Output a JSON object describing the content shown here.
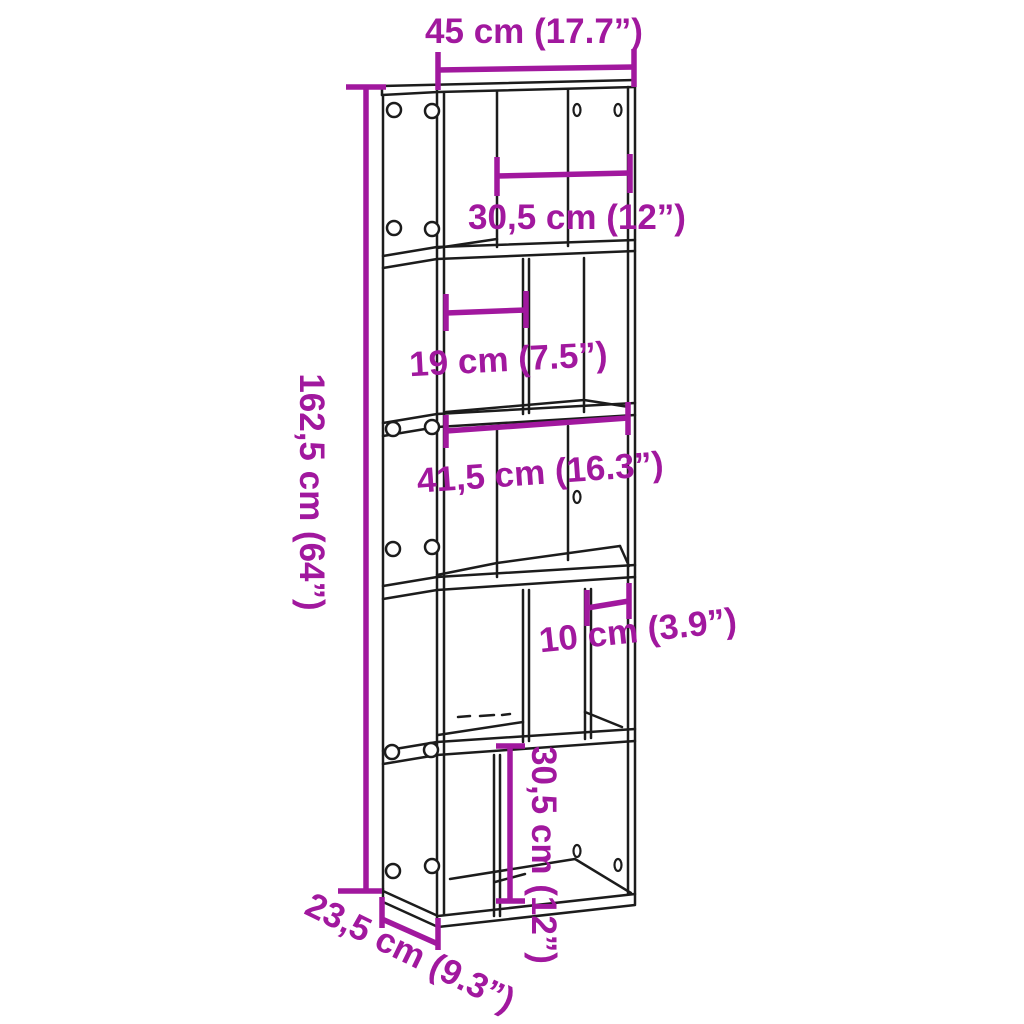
{
  "diagram": {
    "type": "furniture-dimension-diagram",
    "product": "5-tier bookcase",
    "colors": {
      "dimension_annotation": "#a1189e",
      "outline": "#1c1c1c",
      "background": "#ffffff"
    },
    "dimensions": {
      "total_width": {
        "cm": "45",
        "inches": "17.7",
        "label": "45 cm (17.7”)"
      },
      "top_compartment_width": {
        "cm": "30,5",
        "inches": "12",
        "label": "30,5 cm (12”)"
      },
      "second_compartment_width": {
        "cm": "19",
        "inches": "7.5",
        "label": "19 cm (7.5”)"
      },
      "middle_inner_width": {
        "cm": "41,5",
        "inches": "16.3",
        "label": "41,5 cm (16.3”)"
      },
      "fourth_compartment_width": {
        "cm": "10",
        "inches": "3.9",
        "label": "10 cm (3.9”)"
      },
      "bottom_compartment_height": {
        "cm": "30,5",
        "inches": "12",
        "label": "30,5 cm (12”)"
      },
      "total_height": {
        "cm": "162,5",
        "inches": "64",
        "label": "162,5 cm (64”)"
      },
      "total_depth": {
        "cm": "23,5",
        "inches": "9.3",
        "label": "23,5 cm (9.3”)"
      }
    }
  }
}
